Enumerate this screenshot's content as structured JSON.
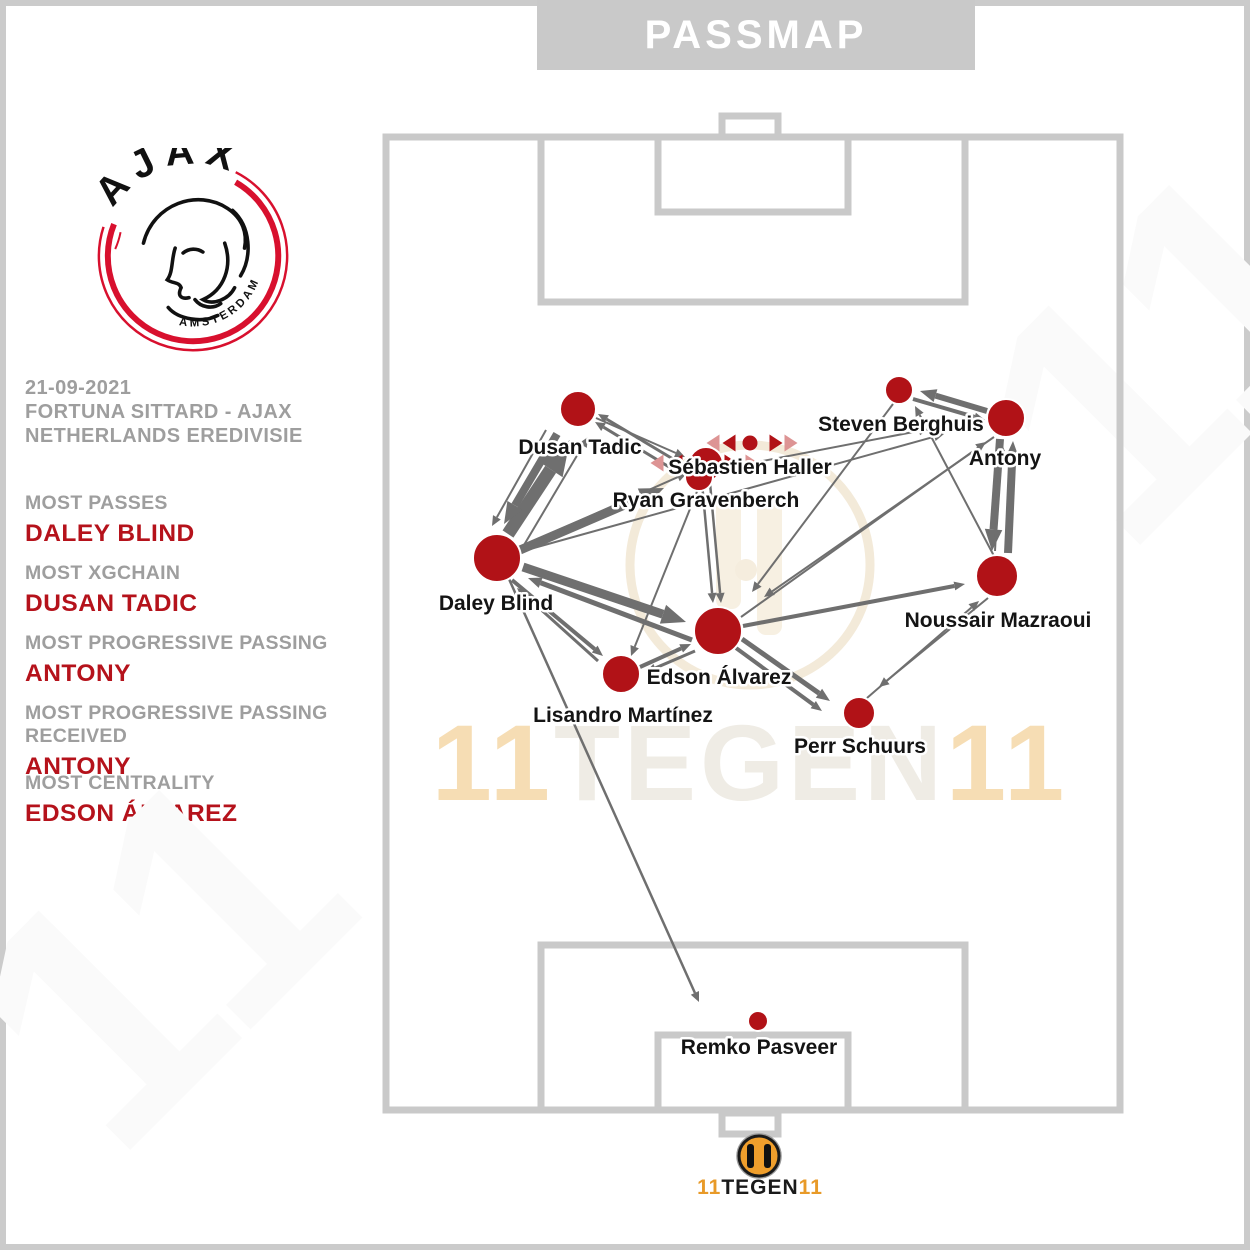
{
  "banner": {
    "title": "PASSMAP"
  },
  "crest": {
    "club": "AJAX",
    "city": "AMSTERDAM"
  },
  "match": {
    "date": "21-09-2021",
    "fixture": "FORTUNA SITTARD - AJAX",
    "competition": "NETHERLANDS EREDIVISIE"
  },
  "stats": [
    {
      "label": "MOST PASSES",
      "value": "DALEY BLIND"
    },
    {
      "label": "MOST XGCHAIN",
      "value": "DUSAN TADIC"
    },
    {
      "label": "MOST PROGRESSIVE PASSING",
      "value": "ANTONY"
    },
    {
      "label": "MOST PROGRESSIVE PASSING RECEIVED",
      "value": "ANTONY"
    },
    {
      "label": "MOST CENTRALITY",
      "value": "EDSON ÁLVAREZ"
    }
  ],
  "watermark": {
    "first": "11",
    "mid": "TEGEN",
    "last": "11"
  },
  "footer": {
    "first": "11",
    "mid": "TEGEN",
    "last": "11"
  },
  "colors": {
    "node": "#b11217",
    "node_light": "#dd9494",
    "edge": "#6f6f6f",
    "accent_red": "#b5121b",
    "pitch_line": "#c9c9c9",
    "banner_bg": "#c9c9c9",
    "muted_gray": "#9e9e9e",
    "logo_orange": "#f09f2c"
  },
  "chart_data": {
    "type": "network",
    "title": "PASSMAP",
    "team": "AJAX",
    "players": [
      {
        "name": "Dusan Tadic",
        "x": 578,
        "y": 409,
        "r": 18,
        "label_x": 580,
        "label_y": 454
      },
      {
        "name": "Sébastien Haller",
        "x": 706,
        "y": 464,
        "r": 17,
        "label_x": 750,
        "label_y": 474
      },
      {
        "name": "Ryan Gravenberch",
        "x": 699,
        "y": 477,
        "r": 14,
        "label_x": 706,
        "label_y": 507
      },
      {
        "name": "Steven Berghuis",
        "x": 899,
        "y": 390,
        "r": 14,
        "label_x": 901,
        "label_y": 431
      },
      {
        "name": "Antony",
        "x": 1006,
        "y": 418,
        "r": 19,
        "label_x": 1005,
        "label_y": 465
      },
      {
        "name": "Daley Blind",
        "x": 497,
        "y": 558,
        "r": 24,
        "label_x": 496,
        "label_y": 610
      },
      {
        "name": "Noussair Mazraoui",
        "x": 997,
        "y": 576,
        "r": 21,
        "label_x": 998,
        "label_y": 627
      },
      {
        "name": "Edson Álvarez",
        "x": 718,
        "y": 631,
        "r": 24,
        "label_x": 719,
        "label_y": 684
      },
      {
        "name": "Lisandro Martínez",
        "x": 621,
        "y": 674,
        "r": 19,
        "label_x": 623,
        "label_y": 722
      },
      {
        "name": "Perr Schuurs",
        "x": 859,
        "y": 713,
        "r": 16,
        "label_x": 860,
        "label_y": 753
      },
      {
        "name": "Remko Pasveer",
        "x": 758,
        "y": 1021,
        "r": 10,
        "label_x": 759,
        "label_y": 1054
      }
    ],
    "edges": [
      {
        "x1": 508,
        "y1": 534,
        "x2": 570,
        "y2": 440,
        "w": 13
      },
      {
        "x1": 557,
        "y1": 434,
        "x2": 504,
        "y2": 524,
        "w": 8
      },
      {
        "x1": 524,
        "y1": 545,
        "x2": 588,
        "y2": 437,
        "w": 2
      },
      {
        "x1": 546,
        "y1": 430,
        "x2": 492,
        "y2": 526,
        "w": 2
      },
      {
        "x1": 520,
        "y1": 550,
        "x2": 664,
        "y2": 488,
        "w": 9
      },
      {
        "x1": 523,
        "y1": 567,
        "x2": 686,
        "y2": 622,
        "w": 9
      },
      {
        "x1": 692,
        "y1": 640,
        "x2": 528,
        "y2": 578,
        "w": 5
      },
      {
        "x1": 512,
        "y1": 580,
        "x2": 603,
        "y2": 656,
        "w": 4
      },
      {
        "x1": 598,
        "y1": 661,
        "x2": 517,
        "y2": 588,
        "w": 3
      },
      {
        "x1": 518,
        "y1": 548,
        "x2": 687,
        "y2": 473,
        "w": 2
      },
      {
        "x1": 688,
        "y1": 468,
        "x2": 598,
        "y2": 414,
        "w": 3
      },
      {
        "x1": 684,
        "y1": 476,
        "x2": 595,
        "y2": 422,
        "w": 3
      },
      {
        "x1": 596,
        "y1": 418,
        "x2": 685,
        "y2": 457,
        "w": 2
      },
      {
        "x1": 702,
        "y1": 483,
        "x2": 713,
        "y2": 603,
        "w": 2.5
      },
      {
        "x1": 710,
        "y1": 483,
        "x2": 721,
        "y2": 603,
        "w": 2.5
      },
      {
        "x1": 987,
        "y1": 411,
        "x2": 920,
        "y2": 391,
        "w": 6
      },
      {
        "x1": 913,
        "y1": 399,
        "x2": 985,
        "y2": 420,
        "w": 4
      },
      {
        "x1": 1000,
        "y1": 439,
        "x2": 992,
        "y2": 551,
        "w": 8
      },
      {
        "x1": 1008,
        "y1": 553,
        "x2": 1013,
        "y2": 441,
        "w": 8
      },
      {
        "x1": 995,
        "y1": 551,
        "x2": 1001,
        "y2": 441,
        "w": 2
      },
      {
        "x1": 742,
        "y1": 639,
        "x2": 830,
        "y2": 701,
        "w": 5
      },
      {
        "x1": 736,
        "y1": 648,
        "x2": 822,
        "y2": 711,
        "w": 4
      },
      {
        "x1": 988,
        "y1": 598,
        "x2": 879,
        "y2": 687,
        "w": 2
      },
      {
        "x1": 867,
        "y1": 698,
        "x2": 979,
        "y2": 601,
        "w": 2
      },
      {
        "x1": 523,
        "y1": 551,
        "x2": 944,
        "y2": 434,
        "w": 2
      },
      {
        "x1": 716,
        "y1": 470,
        "x2": 929,
        "y2": 429,
        "w": 2
      },
      {
        "x1": 994,
        "y1": 437,
        "x2": 764,
        "y2": 597,
        "w": 2
      },
      {
        "x1": 893,
        "y1": 404,
        "x2": 752,
        "y2": 592,
        "w": 2
      },
      {
        "x1": 743,
        "y1": 626,
        "x2": 965,
        "y2": 584,
        "w": 4
      },
      {
        "x1": 640,
        "y1": 667,
        "x2": 691,
        "y2": 644,
        "w": 4
      },
      {
        "x1": 695,
        "y1": 651,
        "x2": 646,
        "y2": 672,
        "w": 3
      },
      {
        "x1": 700,
        "y1": 484,
        "x2": 631,
        "y2": 656,
        "w": 2
      },
      {
        "x1": 509,
        "y1": 579,
        "x2": 699,
        "y2": 1002,
        "w": 2.5
      },
      {
        "x1": 994,
        "y1": 556,
        "x2": 915,
        "y2": 406,
        "w": 2
      },
      {
        "x1": 741,
        "y1": 617,
        "x2": 986,
        "y2": 442,
        "w": 2
      }
    ],
    "substitutions": [
      {
        "cy": 443,
        "shapes": [
          {
            "t": "left",
            "x": 713,
            "shade": "light"
          },
          {
            "t": "left",
            "x": 729,
            "shade": "dark"
          },
          {
            "t": "dot",
            "x": 750,
            "shade": "dark"
          },
          {
            "t": "right",
            "x": 776,
            "shade": "dark"
          },
          {
            "t": "right",
            "x": 791,
            "shade": "light"
          }
        ]
      },
      {
        "cy": 463,
        "shapes": [
          {
            "t": "left",
            "x": 657,
            "shade": "light"
          },
          {
            "t": "left",
            "x": 676,
            "shade": "dark"
          },
          {
            "t": "dot",
            "x": 702,
            "shade": "dark"
          },
          {
            "t": "right",
            "x": 731,
            "shade": "dark"
          },
          {
            "t": "right",
            "x": 752,
            "shade": "light"
          }
        ]
      }
    ]
  }
}
